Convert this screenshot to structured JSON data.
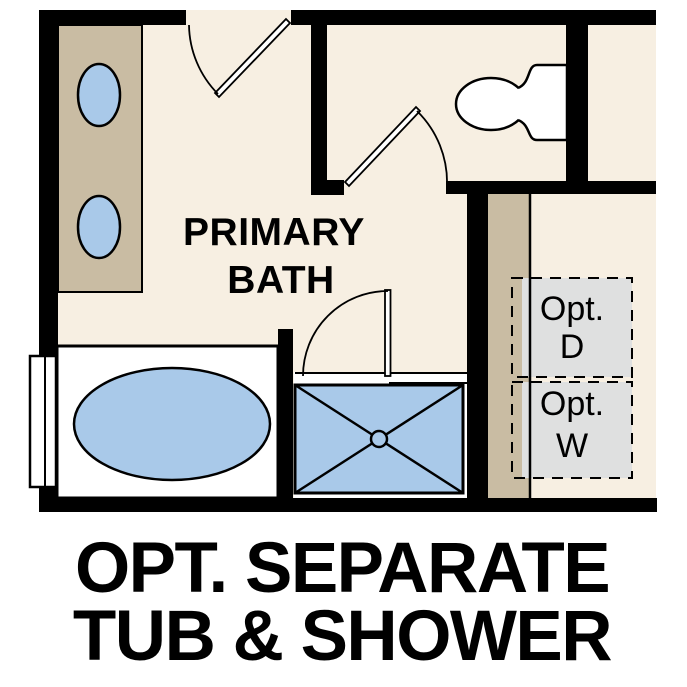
{
  "plan": {
    "room_label": {
      "line1": "PRIMARY",
      "line2": "BATH"
    },
    "opt_dryer": {
      "label": "Opt.",
      "letter": "D"
    },
    "opt_washer": {
      "label": "Opt.",
      "letter": "W"
    },
    "caption": {
      "line1": "OPT. SEPARATE",
      "line2": "TUB & SHOWER"
    }
  },
  "colors": {
    "wall": "#000000",
    "floor": "#f7efe2",
    "counter_tan": "#c9bca3",
    "fixture_blue": "#a9c9e9",
    "optional_gray": "#dfe0e0",
    "fixture_white": "#ffffff",
    "text": "#000000"
  }
}
